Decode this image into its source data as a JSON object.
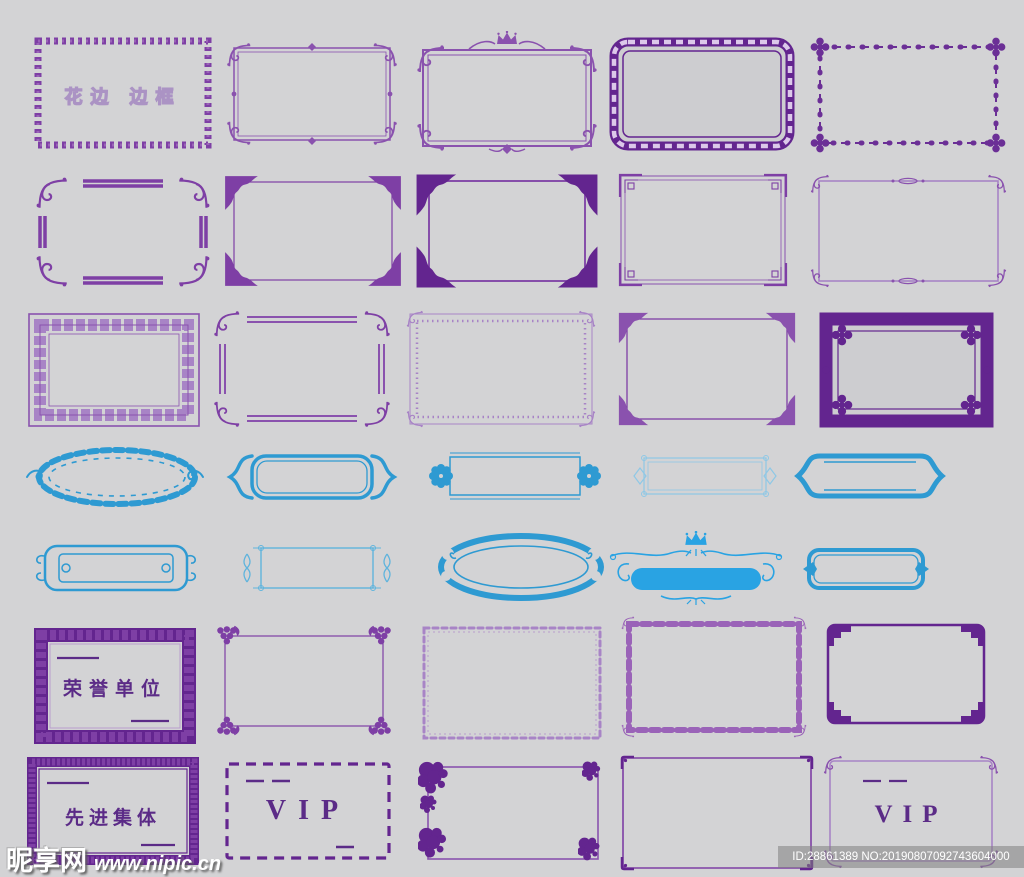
{
  "canvas": {
    "width": 1024,
    "height": 877,
    "background": "#d3d3d5"
  },
  "palette": {
    "purple_dark": "#63258f",
    "purple": "#7e3fa5",
    "purple_medium": "#8a52ae",
    "purple_light": "#a884c6",
    "lavender": "#dcc8ea",
    "blue": "#2e9ad2",
    "blue_bright": "#29a3e3",
    "blue_light": "#8ec8e6",
    "text_purple": "#5b2b87",
    "watermark_white": "#ffffff"
  },
  "sheet": {
    "description": "grid of ornamental lace borders and frames",
    "rows": 7,
    "columns": 5
  },
  "frames": [
    {
      "name": "chain-pattern-frame",
      "color": "purple",
      "label": "花边 边框"
    },
    {
      "name": "flourish-corner-double-line-frame",
      "color": "purple"
    },
    {
      "name": "crown-ornate-frame",
      "color": "purple"
    },
    {
      "name": "rounded-wave-band-frame",
      "color": "purple"
    },
    {
      "name": "dotted-floral-frame",
      "color": "purple"
    },
    {
      "name": "flourish-corner-bar-frame",
      "color": "purple"
    },
    {
      "name": "leaf-corner-frame",
      "color": "purple"
    },
    {
      "name": "bold-leaf-corner-frame",
      "color": "purple"
    },
    {
      "name": "greek-key-corner-frame",
      "color": "purple"
    },
    {
      "name": "petite-ornament-frame",
      "color": "purple"
    },
    {
      "name": "meander-band-frame",
      "color": "purple"
    },
    {
      "name": "gapped-double-line-frame",
      "color": "purple"
    },
    {
      "name": "beaded-border-frame",
      "color": "purple"
    },
    {
      "name": "floral-spray-corner-frame",
      "color": "purple"
    },
    {
      "name": "heavy-ornate-frame",
      "color": "purple"
    },
    {
      "name": "laurel-wreath-oval-banner",
      "color": "blue"
    },
    {
      "name": "curly-bracket-banner",
      "color": "blue"
    },
    {
      "name": "rosette-end-banner",
      "color": "blue"
    },
    {
      "name": "fine-line-banner",
      "color": "blue"
    },
    {
      "name": "bold-bracket-banner",
      "color": "blue"
    },
    {
      "name": "cloud-scroll-plaque",
      "color": "blue"
    },
    {
      "name": "flourish-side-banner",
      "color": "blue"
    },
    {
      "name": "cloud-scallop-oval",
      "color": "blue"
    },
    {
      "name": "crown-swirl-banner",
      "color": "blue"
    },
    {
      "name": "diamond-side-plaque",
      "color": "blue"
    },
    {
      "name": "thick-solid-frame",
      "color": "purple",
      "label": "荣誉单位"
    },
    {
      "name": "grape-corner-frame",
      "color": "purple"
    },
    {
      "name": "loop-chain-frame",
      "color": "purple"
    },
    {
      "name": "scroll-pattern-frame",
      "color": "purple"
    },
    {
      "name": "stepped-corner-frame",
      "color": "purple"
    },
    {
      "name": "rough-solid-frame",
      "color": "purple",
      "label": "先进集体"
    },
    {
      "name": "dashed-frame",
      "color": "purple",
      "label": "VIP"
    },
    {
      "name": "grunge-corner-frame",
      "color": "purple"
    },
    {
      "name": "plain-corner-frame",
      "color": "purple"
    },
    {
      "name": "ornate-corner-frame",
      "color": "purple",
      "label": "VIP"
    }
  ],
  "watermarks": {
    "site_name": "昵享网",
    "site_url": "www.nipic.cn",
    "image_id": "ID:28861389 NO:20190807092743604000"
  }
}
